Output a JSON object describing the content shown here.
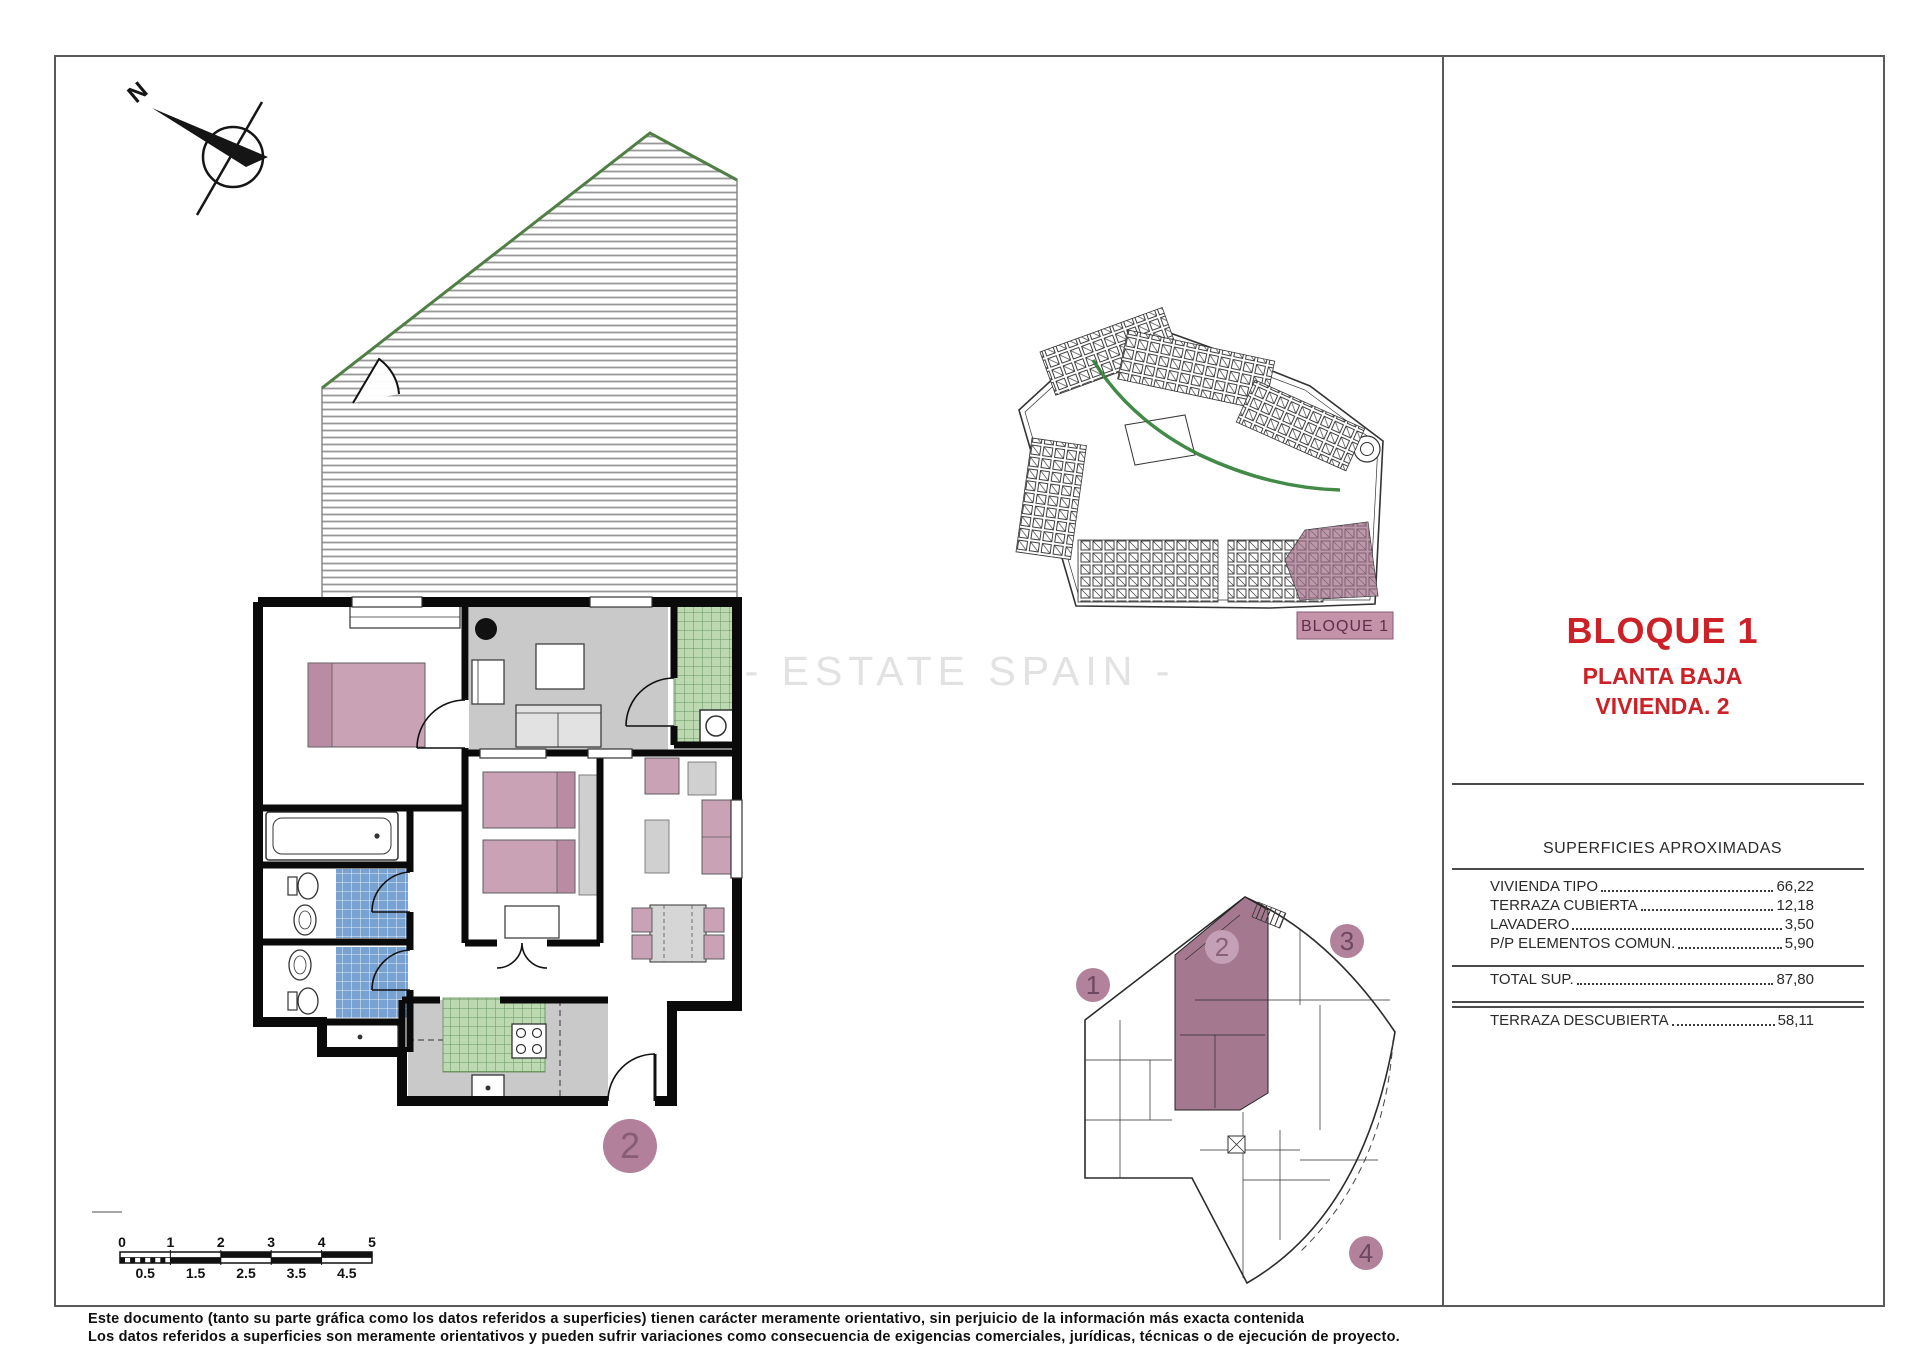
{
  "page": {
    "watermark": "- ESTATE SPAIN -",
    "disclaimer_line1": "Este documento (tanto su parte gráfica como los datos referidos a superficies) tienen carácter meramente orientativo, sin perjuicio de la información más exacta contenida",
    "disclaimer_line2": "Los datos referidos a superficies son meramente orientativos y pueden sufrir variaciones como consecuencia de exigencias comerciales, jurídicas, técnicas o de ejecución de proyecto."
  },
  "title_panel": {
    "block_title": "BLOQUE 1",
    "subtitle_line1": "PLANTA BAJA",
    "subtitle_line2": "VIVIENDA. 2",
    "table": {
      "heading": "SUPERFICIES APROXIMADAS",
      "rows": [
        {
          "label": "VIVIENDA TIPO",
          "value": "66,22"
        },
        {
          "label": "TERRAZA CUBIERTA",
          "value": "12,18"
        },
        {
          "label": "LAVADERO",
          "value": "3,50"
        },
        {
          "label": "P/P ELEMENTOS COMUN.",
          "value": "5,90"
        }
      ],
      "total": {
        "label": "TOTAL SUP.",
        "value": "87,80"
      },
      "extra": {
        "label": "TERRAZA DESCUBIERTA",
        "value": "58,11"
      }
    }
  },
  "site_plan": {
    "block_label": "BLOQUE 1"
  },
  "key_plan": {
    "units": [
      "1",
      "2",
      "3",
      "4"
    ]
  },
  "floor_plan": {
    "unit_badge": "2",
    "north_label": "N"
  },
  "scale_bar": {
    "top_labels": [
      "0",
      "1",
      "2",
      "3",
      "4",
      "5"
    ],
    "bottom_labels": [
      "0.5",
      "1.5",
      "2.5",
      "3.5",
      "4.5"
    ]
  },
  "colors": {
    "title_red": "#cc2127",
    "unit_highlight": "#9d6f88",
    "site_highlight": "#9e6d87",
    "badge_fill": "#b2809a",
    "label_box": "#c493aa",
    "tile_green": "#bcd9b2",
    "tile_blue": "#78a2d2",
    "furniture_pink": "#c9a2b6"
  }
}
